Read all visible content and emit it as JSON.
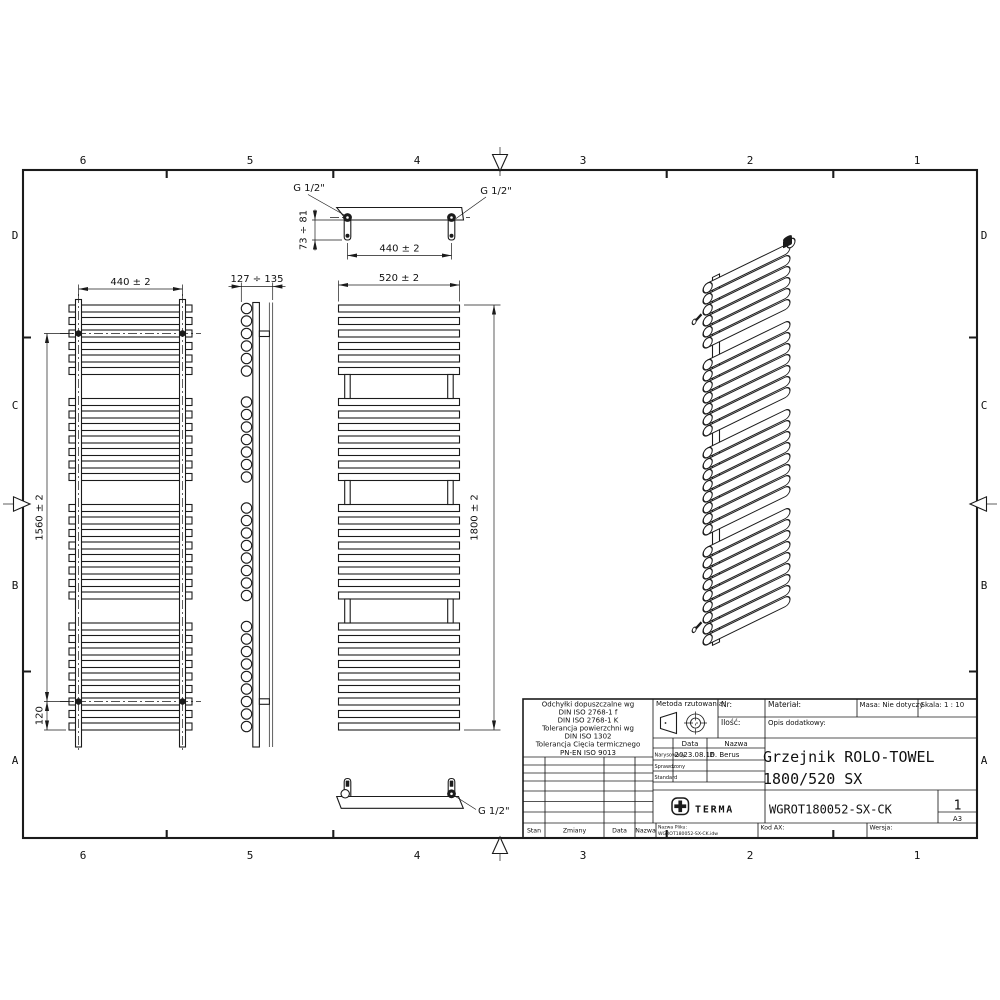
{
  "sheet": {
    "bg": "#ffffff",
    "ink": "#1b1b1b",
    "cols": [
      "6",
      "5",
      "4",
      "3",
      "2",
      "1"
    ],
    "rows": [
      "D",
      "C",
      "B",
      "A"
    ]
  },
  "views": {
    "tube_groups": [
      6,
      7,
      8,
      9
    ],
    "rear": {
      "width_dim": "440 ± 2",
      "mount_dim": "1560 ± 2",
      "bottom_dim": "120"
    },
    "side": {
      "depth_dim": "127 ÷ 135"
    },
    "top": {
      "left_conn": "G 1/2\"",
      "right_conn": "G 1/2\"",
      "offset_dim": "73 ÷ 81",
      "conn_dim": "440 ± 2"
    },
    "front": {
      "width_dim": "520 ± 2",
      "height_dim": "1800 ± 2"
    },
    "bottom": {
      "conn": "G 1/2\""
    }
  },
  "titleblock": {
    "tolerances": [
      "Odchyłki dopuszczalne wg",
      "DIN ISO 2768-1 f",
      "DIN ISO 2768-1 K",
      "Tolerancja powierzchni wg",
      "DIN ISO 1302",
      "Tolerancja Cięcia termicznego",
      "PN-EN ISO 9013"
    ],
    "projection_label": "Metoda rzutowania:",
    "nr_label": "Nr:",
    "qty_label": "Ilość:",
    "material_label": "Materiał:",
    "mass_label": "Masa: Nie dotyczy",
    "scale_label": "Skala: 1 : 10",
    "desc_label": "Opis dodatkowy:",
    "col_date": "Data",
    "col_name": "Nazwa",
    "row_drawn": "Narysowany",
    "drawn_date": "2023.08.16",
    "drawn_by": "D. Berus",
    "row_checked": "Sprawdzony",
    "row_standard": "Standard",
    "title_line1": "Grzejnik ROLO-TOWEL",
    "title_line2": "1800/520 SX",
    "brand": "TERMA",
    "part_number": "WGROT180052-SX-CK",
    "sheet_no": "1",
    "format": "A3",
    "stan_label": "Stan",
    "changes_label": "Zmiany",
    "date_label": "Data",
    "name_label": "Nazwa",
    "file_label": "Nazwa Pliku:",
    "file_name": "WGROT180052-SX-CK.idw",
    "kod_label": "Kod AX:",
    "version_label": "Wersja:"
  }
}
